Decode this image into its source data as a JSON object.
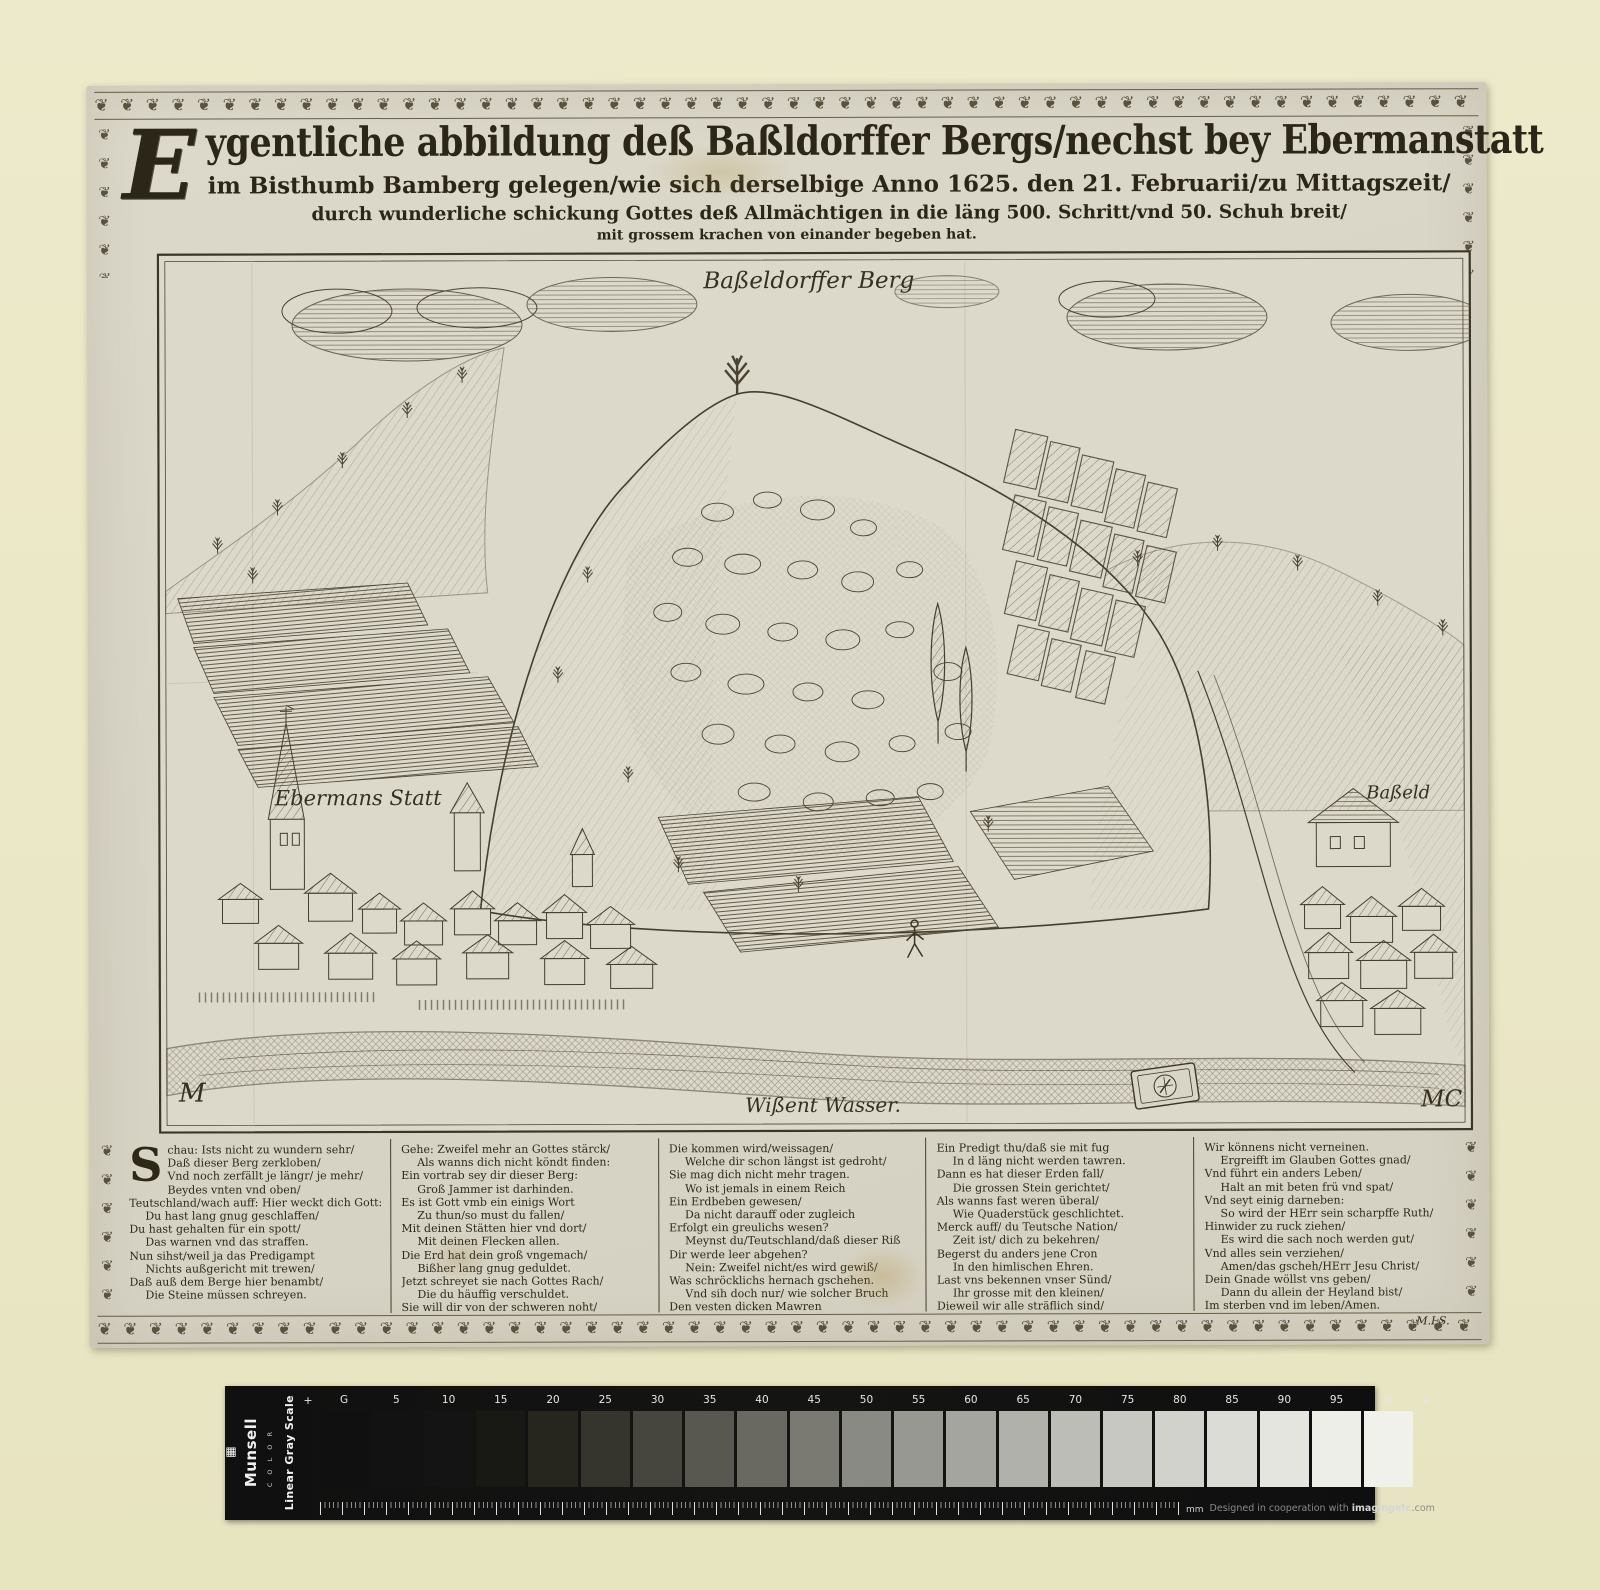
{
  "title": {
    "drop_cap": "E",
    "line1_rest": "ygentliche abbildung deß Baßldorffer Bergs/nechst bey Ebermanstatt",
    "line2": "im Bisthumb Bamberg gelegen/wie sich derselbige Anno 1625. den 21. Februarii/zu Mittagszeit/",
    "line3": "durch wunderliche schickung Gottes deß Allmächtigen in die läng 500. Schritt/vnd 50. Schuh breit/",
    "line4": "mit grossem krachen von einander begeben hat."
  },
  "engraving": {
    "label_mountain": "Baßeldorffer Berg",
    "label_town_left": "Ebermans Statt",
    "label_town_right": "Baßeld",
    "label_river": "Wißent Wasser.",
    "monogram_left": "M",
    "monogram_right": "MC"
  },
  "verses": {
    "column1": {
      "drop_cap": "S",
      "lines": [
        "chau: Ists nicht zu wundern sehr/",
        "Daß dieser Berg zerkloben/",
        "Vnd noch zerfällt je längr/ je mehr/",
        "Beydes vnten vnd oben/",
        "Teutschland/wach auff: Hier weckt dich Gott:",
        "Du hast lang gnug geschlaffen/",
        "Du hast gehalten für ein spott/",
        "Das warnen vnd das straffen.",
        "Nun sihst/weil ja das Predigampt",
        "Nichts außgericht mit trewen/",
        "Daß auß dem Berge hier benambt/",
        "Die Steine müssen schreyen."
      ]
    },
    "column2": {
      "lines": [
        "Gehe: Zweifel mehr an Gottes stärck/",
        "Als wanns dich nicht köndt finden:",
        "Ein vortrab sey dir dieser Berg:",
        "Groß Jammer ist darhinden.",
        "Es ist Gott vmb ein einigs Wort",
        "Zu thun/so must du fallen/",
        "Mit deinen Stätten hier vnd dort/",
        "Mit deinen Flecken allen.",
        "Die Erd hat dein groß vngemach/",
        "Bißher lang gnug geduldet.",
        "Jetzt schreyet sie nach Gottes Rach/",
        "Die du häuffig verschuldet.",
        "Sie will dir von der schweren noht/"
      ]
    },
    "column3": {
      "lines": [
        "Die kommen wird/weissagen/",
        "Welche dir schon längst ist gedroht/",
        "Sie mag dich nicht mehr tragen.",
        "Wo ist jemals in einem Reich",
        "Ein Erdbeben gewesen/",
        "Da nicht darauff oder zugleich",
        "Erfolgt ein greulichs wesen?",
        "Meynst du/Teutschland/daß dieser Riß",
        "Dir werde leer abgehen?",
        "Nein: Zweifel nicht/es wird gewiß/",
        "Was schröcklichs hernach gschehen.",
        "Vnd sih doch nur/ wie solcher Bruch",
        "Den vesten dicken Mawren"
      ]
    },
    "column4": {
      "lines": [
        "Ein Predigt thu/daß sie mit fug",
        "In d läng nicht werden tawren.",
        "Dann es hat dieser Erden fall/",
        "Die grossen Stein gerichtet/",
        "Als wanns fast weren überal/",
        "Wie Quaderstück geschlichtet.",
        "Merck auff/ du Teutsche Nation/",
        "Zeit ist/ dich zu bekehren/",
        "Begerst du anders jene Cron",
        "In den himlischen Ehren.",
        "Last vns bekennen vnser Sünd/",
        "Ihr grosse mit den kleinen/",
        "Dieweil wir alle sträflich sind/"
      ]
    },
    "column5": {
      "lines": [
        "Wir könnens nicht verneinen.",
        "Ergreifft im Glauben Gottes gnad/",
        "Vnd führt ein anders Leben/",
        "Halt an mit beten frü vnd spat/",
        "Vnd seyt einig darneben:",
        "So wird der HErr sein scharpffe Ruth/",
        "Hinwider zu ruck ziehen/",
        "Es wird die sach noch werden gut/",
        "Vnd alles sein verziehen/",
        "Amen/das gscheh/HErr Jesu Christ/",
        "Dein Gnade wöllst vns geben/",
        "Dann du allein der Heyland bist/",
        "Im sterben vnd im leben/Amen."
      ],
      "signature": "M.I.S."
    }
  },
  "gray_scale": {
    "brand": "Munsell",
    "brand_sub": "C O L O R",
    "scale_name": "Linear Gray Scale",
    "logo_glyph": "▦",
    "plus_left": "+",
    "plus_right": "+",
    "patches": [
      {
        "label": "G",
        "color": "#101010"
      },
      {
        "label": "5",
        "color": "#121212"
      },
      {
        "label": "10",
        "color": "#141414"
      },
      {
        "label": "15",
        "color": "#181815"
      },
      {
        "label": "20",
        "color": "#26261f"
      },
      {
        "label": "25",
        "color": "#35352e"
      },
      {
        "label": "30",
        "color": "#46463f"
      },
      {
        "label": "35",
        "color": "#585851"
      },
      {
        "label": "40",
        "color": "#696962"
      },
      {
        "label": "45",
        "color": "#7a7a73"
      },
      {
        "label": "50",
        "color": "#8a8a84"
      },
      {
        "label": "55",
        "color": "#989892"
      },
      {
        "label": "60",
        "color": "#a5a59f"
      },
      {
        "label": "65",
        "color": "#b1b1ab"
      },
      {
        "label": "70",
        "color": "#bdbdb7"
      },
      {
        "label": "75",
        "color": "#c8c8c2"
      },
      {
        "label": "80",
        "color": "#d2d2cc"
      },
      {
        "label": "85",
        "color": "#dcdcd6"
      },
      {
        "label": "90",
        "color": "#e5e5df"
      },
      {
        "label": "95",
        "color": "#eeeee8"
      },
      {
        "label": "G",
        "color": "#f1f1eb"
      }
    ],
    "ruler_label": "mm",
    "credit_prefix": "Designed in cooperation with ",
    "credit_brand": "imagingetc",
    "credit_suffix": ".com"
  },
  "decor": {
    "border_glyph": "❦"
  },
  "colors": {
    "page_background": "#ebe8c8",
    "paper": "#d9d5c7",
    "ink": "#2b2617"
  }
}
